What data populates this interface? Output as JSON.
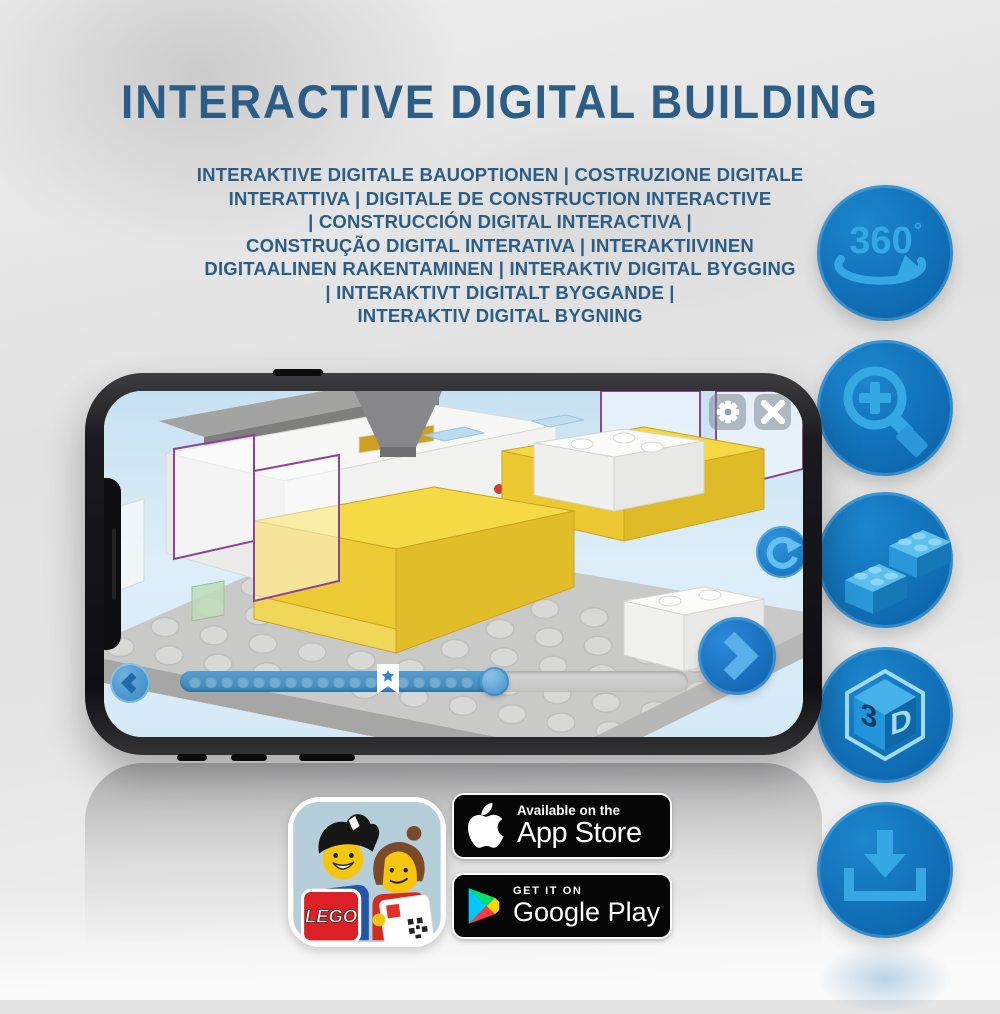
{
  "title": "INTERACTIVE DIGITAL BUILDING",
  "subtitle_lines": [
    "INTERAKTIVE DIGITALE BAUOPTIONEN | COSTRUZIONE DIGITALE",
    "INTERATTIVA | DIGITALE DE CONSTRUCTION INTERACTIVE",
    "| CONSTRUCCIÓN DIGITAL INTERACTIVA |",
    "CONSTRUÇÃO DIGITAL INTERATIVA | INTERAKTIIVINEN",
    "DIGITAALINEN RAKENTAMINEN | INTERAKTIV DIGITAL BYGGING",
    "| INTERAKTIVT DIGITALT BYGGANDE |",
    "INTERAKTIV DIGITAL BYGNING"
  ],
  "feature_icons": [
    {
      "name": "360-rotation-icon",
      "label": "360",
      "degree_symbol": "°"
    },
    {
      "name": "zoom-in-icon"
    },
    {
      "name": "lego-bricks-icon"
    },
    {
      "name": "3d-cube-icon",
      "left_face": "3",
      "right_face": "D"
    },
    {
      "name": "download-icon"
    }
  ],
  "phone_app": {
    "hud_icons": [
      "gear-icon",
      "close-icon",
      "rotate-icon",
      "chevron-left-icon",
      "chevron-right-icon"
    ],
    "progress": {
      "dot_count": 18,
      "filled_percent": 62,
      "bookmark_percent": 41
    }
  },
  "badges": {
    "app_store": {
      "tagline": "Available on the",
      "store_name": "App Store"
    },
    "google_play": {
      "tagline": "GET IT ON",
      "store_name": "Google Play"
    },
    "lego_logo_text": "LEGO"
  },
  "colors": {
    "heading_text": "#2b5d86",
    "icon_circle": "#0e6cb2",
    "icon_glyph": "#35a7e4",
    "screen_sky": "#cfe6f5",
    "lego_yellow": "#f2d63e",
    "ghost_outline": "#8e4398",
    "badge_bg": "#060606",
    "play_triangle": [
      "#00c9ff",
      "#00e26b",
      "#ffd500",
      "#ff3a44"
    ],
    "lego_red": "#dd1f26"
  }
}
